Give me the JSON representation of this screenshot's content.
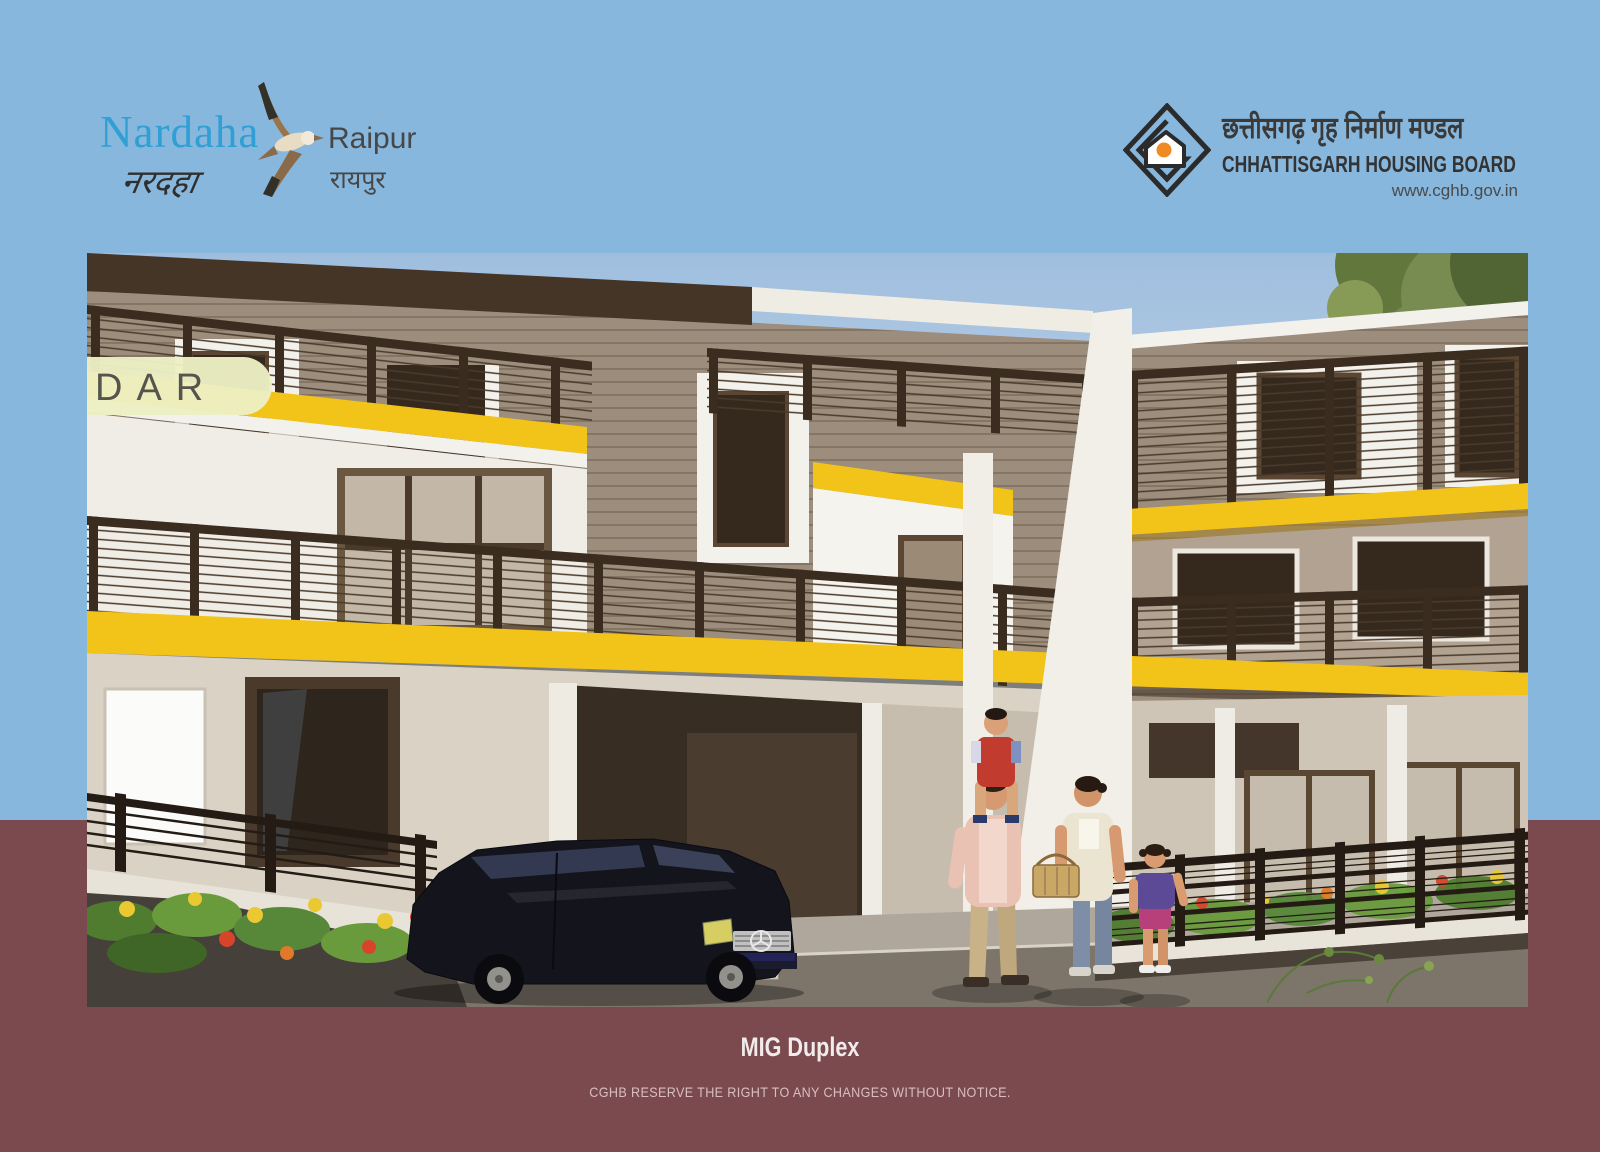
{
  "page": {
    "bg_top_color": "#87b7dd",
    "bg_bottom_color": "#7b4a4e",
    "bg_split_y": 820
  },
  "branding_left": {
    "name_latin": "Nardaha",
    "name_devanagari": "नरदहा",
    "city_latin": "Raipur",
    "city_devanagari": "रायपुर",
    "name_color": "#2f9fd4",
    "bird_icon": "flying-gannet-bird"
  },
  "branding_right": {
    "org_devanagari": "छत्तीसगढ़ गृह निर्माण मण्डल",
    "org_latin": "CHHATTISGARH HOUSING BOARD",
    "website": "www.cghb.gov.in",
    "logo_icon": "diamond-house-logo",
    "logo_accent_color": "#f08a24"
  },
  "artwork": {
    "type": "architectural-rendering",
    "subject": "Exterior view of two-storey MIG duplex housing units with yellow balcony bands, dark railings, a parked car and a family of four",
    "watermark_fragment": "DAR",
    "accent_band_color": "#f2c318"
  },
  "footer": {
    "title": "MIG Duplex",
    "disclaimer": "CGHB RESERVE THE RIGHT TO ANY CHANGES WITHOUT NOTICE."
  }
}
